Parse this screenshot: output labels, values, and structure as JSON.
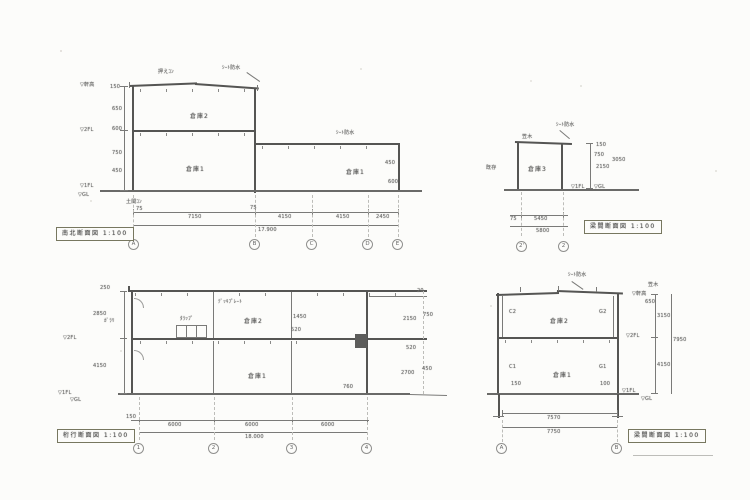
{
  "a": {
    "title": "南北断面図 1:100",
    "grids": [
      "A",
      "B",
      "C",
      "D",
      "E"
    ],
    "rooms": {
      "upper": "倉庫2",
      "lower": "倉庫1",
      "annex": "倉庫1"
    },
    "levels": {
      "eave": "▽軒高",
      "fl2": "▽2FL",
      "fl1": "▽1FL",
      "gl": "▽GL"
    },
    "vdims": [
      "150",
      "650",
      "600",
      "750",
      "450"
    ],
    "hdims": [
      "7150",
      "4150",
      "4150",
      "2450"
    ],
    "hsmall": [
      "75",
      "75"
    ],
    "total": "17.900",
    "notes": {
      "roof1": "押えｺﾝ",
      "roof2": "ｼｰﾄ防水",
      "annex": "ｼｰﾄ防水",
      "slab": "土間ｺﾝ",
      "d1": "450",
      "d2": "600"
    }
  },
  "b": {
    "title": "梁間断面図 1:100",
    "grids": [
      "2'",
      "2"
    ],
    "room": "倉庫3",
    "levels": {
      "fl1": "▽1FL",
      "gl": "▽GL"
    },
    "notes": {
      "roof": "ｼｰﾄ防水",
      "kasagi": "笠木",
      "left": "既存"
    },
    "vdims": [
      "150",
      "750",
      "2150"
    ],
    "vtotal": "3050",
    "hdims": [
      "75",
      "5450"
    ],
    "htotal": "5800"
  },
  "c": {
    "title": "桁行断面図 1:100",
    "grids": [
      "1",
      "2",
      "3",
      "4"
    ],
    "rooms": {
      "upper": "倉庫2",
      "lower": "倉庫1"
    },
    "levels": {
      "fl2": "▽2FL",
      "fl1": "▽1FL",
      "gl": "▽GL"
    },
    "vdims": [
      "2850",
      "4150"
    ],
    "rdims": [
      "750",
      "2150",
      "520",
      "450",
      "2700"
    ],
    "idims": [
      "1450",
      "520",
      "760"
    ],
    "hdims": [
      "150",
      "6000",
      "6000",
      "6000"
    ],
    "total": "18.000",
    "notes": {
      "deck": "ﾃﾞｯｷﾌﾟﾚｰﾄ",
      "garari": "ｶﾞﾗﾘ",
      "tarap": "ﾀﾗｯﾌﾟ",
      "eave": "250",
      "c20": "20"
    }
  },
  "d": {
    "title": "梁間断面図 1:100",
    "grids": [
      "A",
      "B"
    ],
    "rooms": {
      "upper": "倉庫2",
      "lower": "倉庫1"
    },
    "levels": {
      "eave": "▽軒高",
      "fl2": "▽2FL",
      "fl1": "▽1FL",
      "gl": "▽GL"
    },
    "marks": {
      "c2": "C2",
      "g2": "G2",
      "c1": "C1",
      "g1": "G1",
      "s1": "150",
      "s2": "100"
    },
    "notes": {
      "roof": "ｼｰﾄ防水",
      "kasagi": "笠木"
    },
    "vdims": [
      "650",
      "3150",
      "4150"
    ],
    "vtotal": "7950",
    "hdim": "7570",
    "htotal": "7750"
  }
}
